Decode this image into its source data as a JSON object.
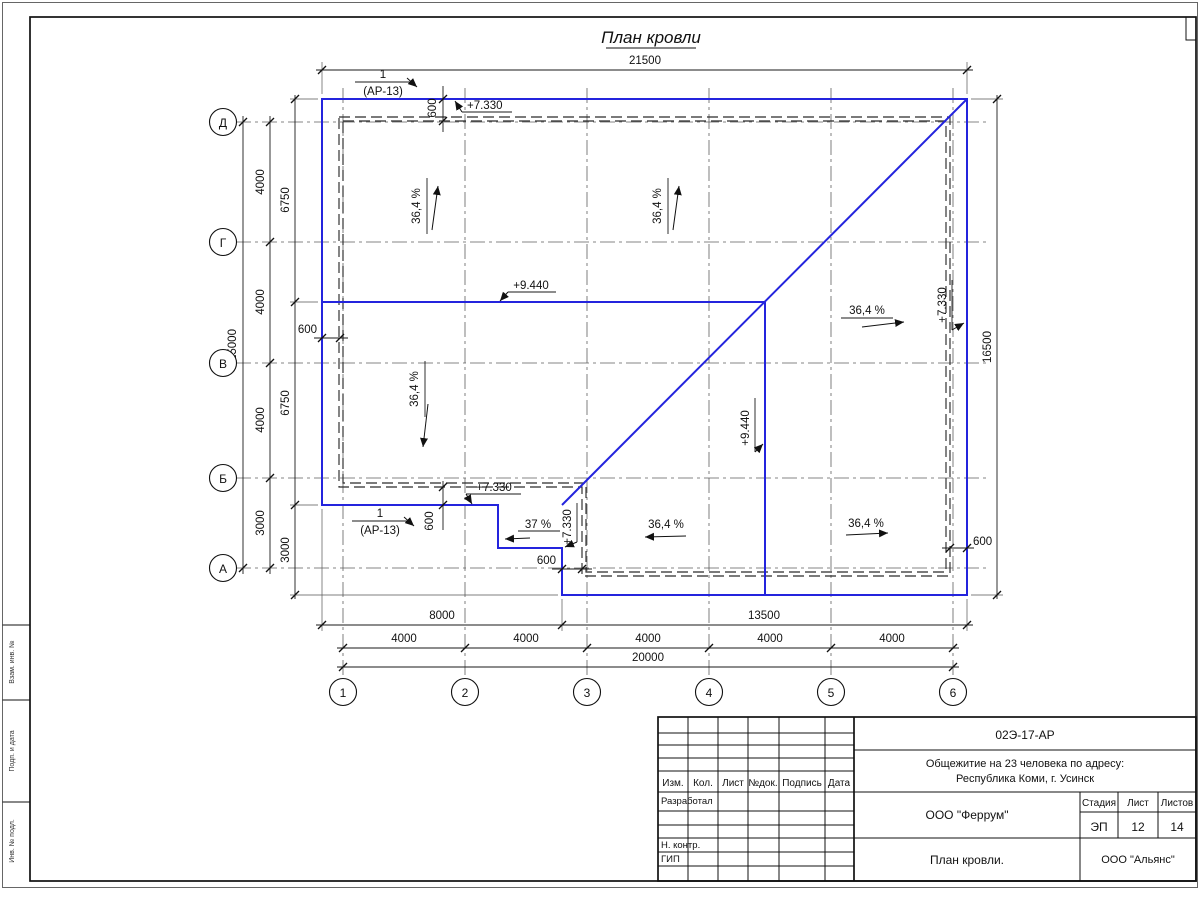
{
  "figure": {
    "title": "План кровли",
    "slope_main": "36,4 %",
    "slope_porch": "37 %",
    "elev_eave": "+7.330",
    "elev_ridge": "+9.440",
    "callout_num": "1",
    "callout_ref": "(АР-13)"
  },
  "dims": {
    "top_total": "21500",
    "right_total": "16500",
    "left_total": "15000",
    "bottom_total": "20000",
    "bottom_left": "8000",
    "bottom_right": "13500",
    "overhang": "600",
    "left_outer": [
      "4000",
      "4000",
      "4000",
      "3000"
    ],
    "left_inner": [
      "6750",
      "6750",
      "3000"
    ],
    "bottom_axes": [
      "4000",
      "4000",
      "4000",
      "4000",
      "4000"
    ]
  },
  "axes": {
    "rows": [
      "Д",
      "Г",
      "В",
      "Б",
      "А"
    ],
    "cols": [
      "1",
      "2",
      "3",
      "4",
      "5",
      "6"
    ]
  },
  "titleblock": {
    "doc_number": "02Э-17-АР",
    "project_line1": "Общежитие на 23 человека по адресу:",
    "project_line2": "Республика Коми, г. Усинск",
    "header_cols": [
      "Изм.",
      "Кол.",
      "Лист",
      "№док.",
      "Подпись",
      "Дата"
    ],
    "row_developer": "Разработал",
    "row_ncontrol": "Н. контр.",
    "row_gip": "ГИП",
    "org": "ООО \"Феррум\"",
    "stage_label": "Стадия",
    "sheet_label": "Лист",
    "sheets_label": "Листов",
    "stage": "ЭП",
    "sheet": "12",
    "sheets": "14",
    "drawing_name": "План кровли.",
    "contractor": "ООО \"Альянс\""
  },
  "margin": {
    "labels": [
      "Взам. инв. №",
      "Подп. и дата",
      "Инв. № подл."
    ]
  },
  "colors": {
    "roof_line": "#2424dd",
    "drawing_line": "#1a1a1a"
  }
}
